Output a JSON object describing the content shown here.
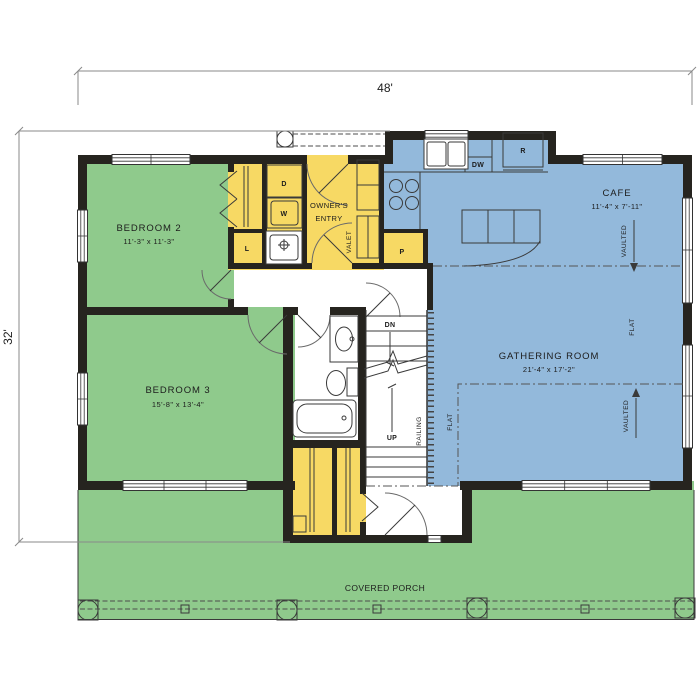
{
  "plan": {
    "overall_width": "48'",
    "overall_depth": "32'",
    "rooms": {
      "bedroom2": {
        "name": "BEDROOM 2",
        "size": "11'-3\" x 11'-3\""
      },
      "bedroom3": {
        "name": "BEDROOM 3",
        "size": "15'-8\" x 13'-4\""
      },
      "cafe": {
        "name": "CAFE",
        "size": "11'-4\" x 7'-11\""
      },
      "gathering_room": {
        "name": "GATHERING ROOM",
        "size": "21'-4\" x 17'-2\""
      },
      "owners_entry": {
        "name_line1": "OWNER'S",
        "name_line2": "ENTRY"
      },
      "covered_porch": {
        "name": "COVERED PORCH"
      }
    },
    "fixtures": {
      "dryer": "D",
      "washer": "W",
      "linen": "L",
      "pantry": "P",
      "dishwasher": "DW",
      "refrigerator": "R",
      "valet": "VALET"
    },
    "stairs": {
      "down": "DN",
      "up": "UP",
      "railing": "RAILING"
    },
    "ceiling_notes": {
      "flat": "FLAT",
      "vaulted": "VAULTED"
    },
    "colors": {
      "bedroom_porch_green": "#8FCA8C",
      "living_blue": "#93B9DB",
      "utility_yellow": "#F7D964",
      "wall": "#26241F"
    }
  }
}
